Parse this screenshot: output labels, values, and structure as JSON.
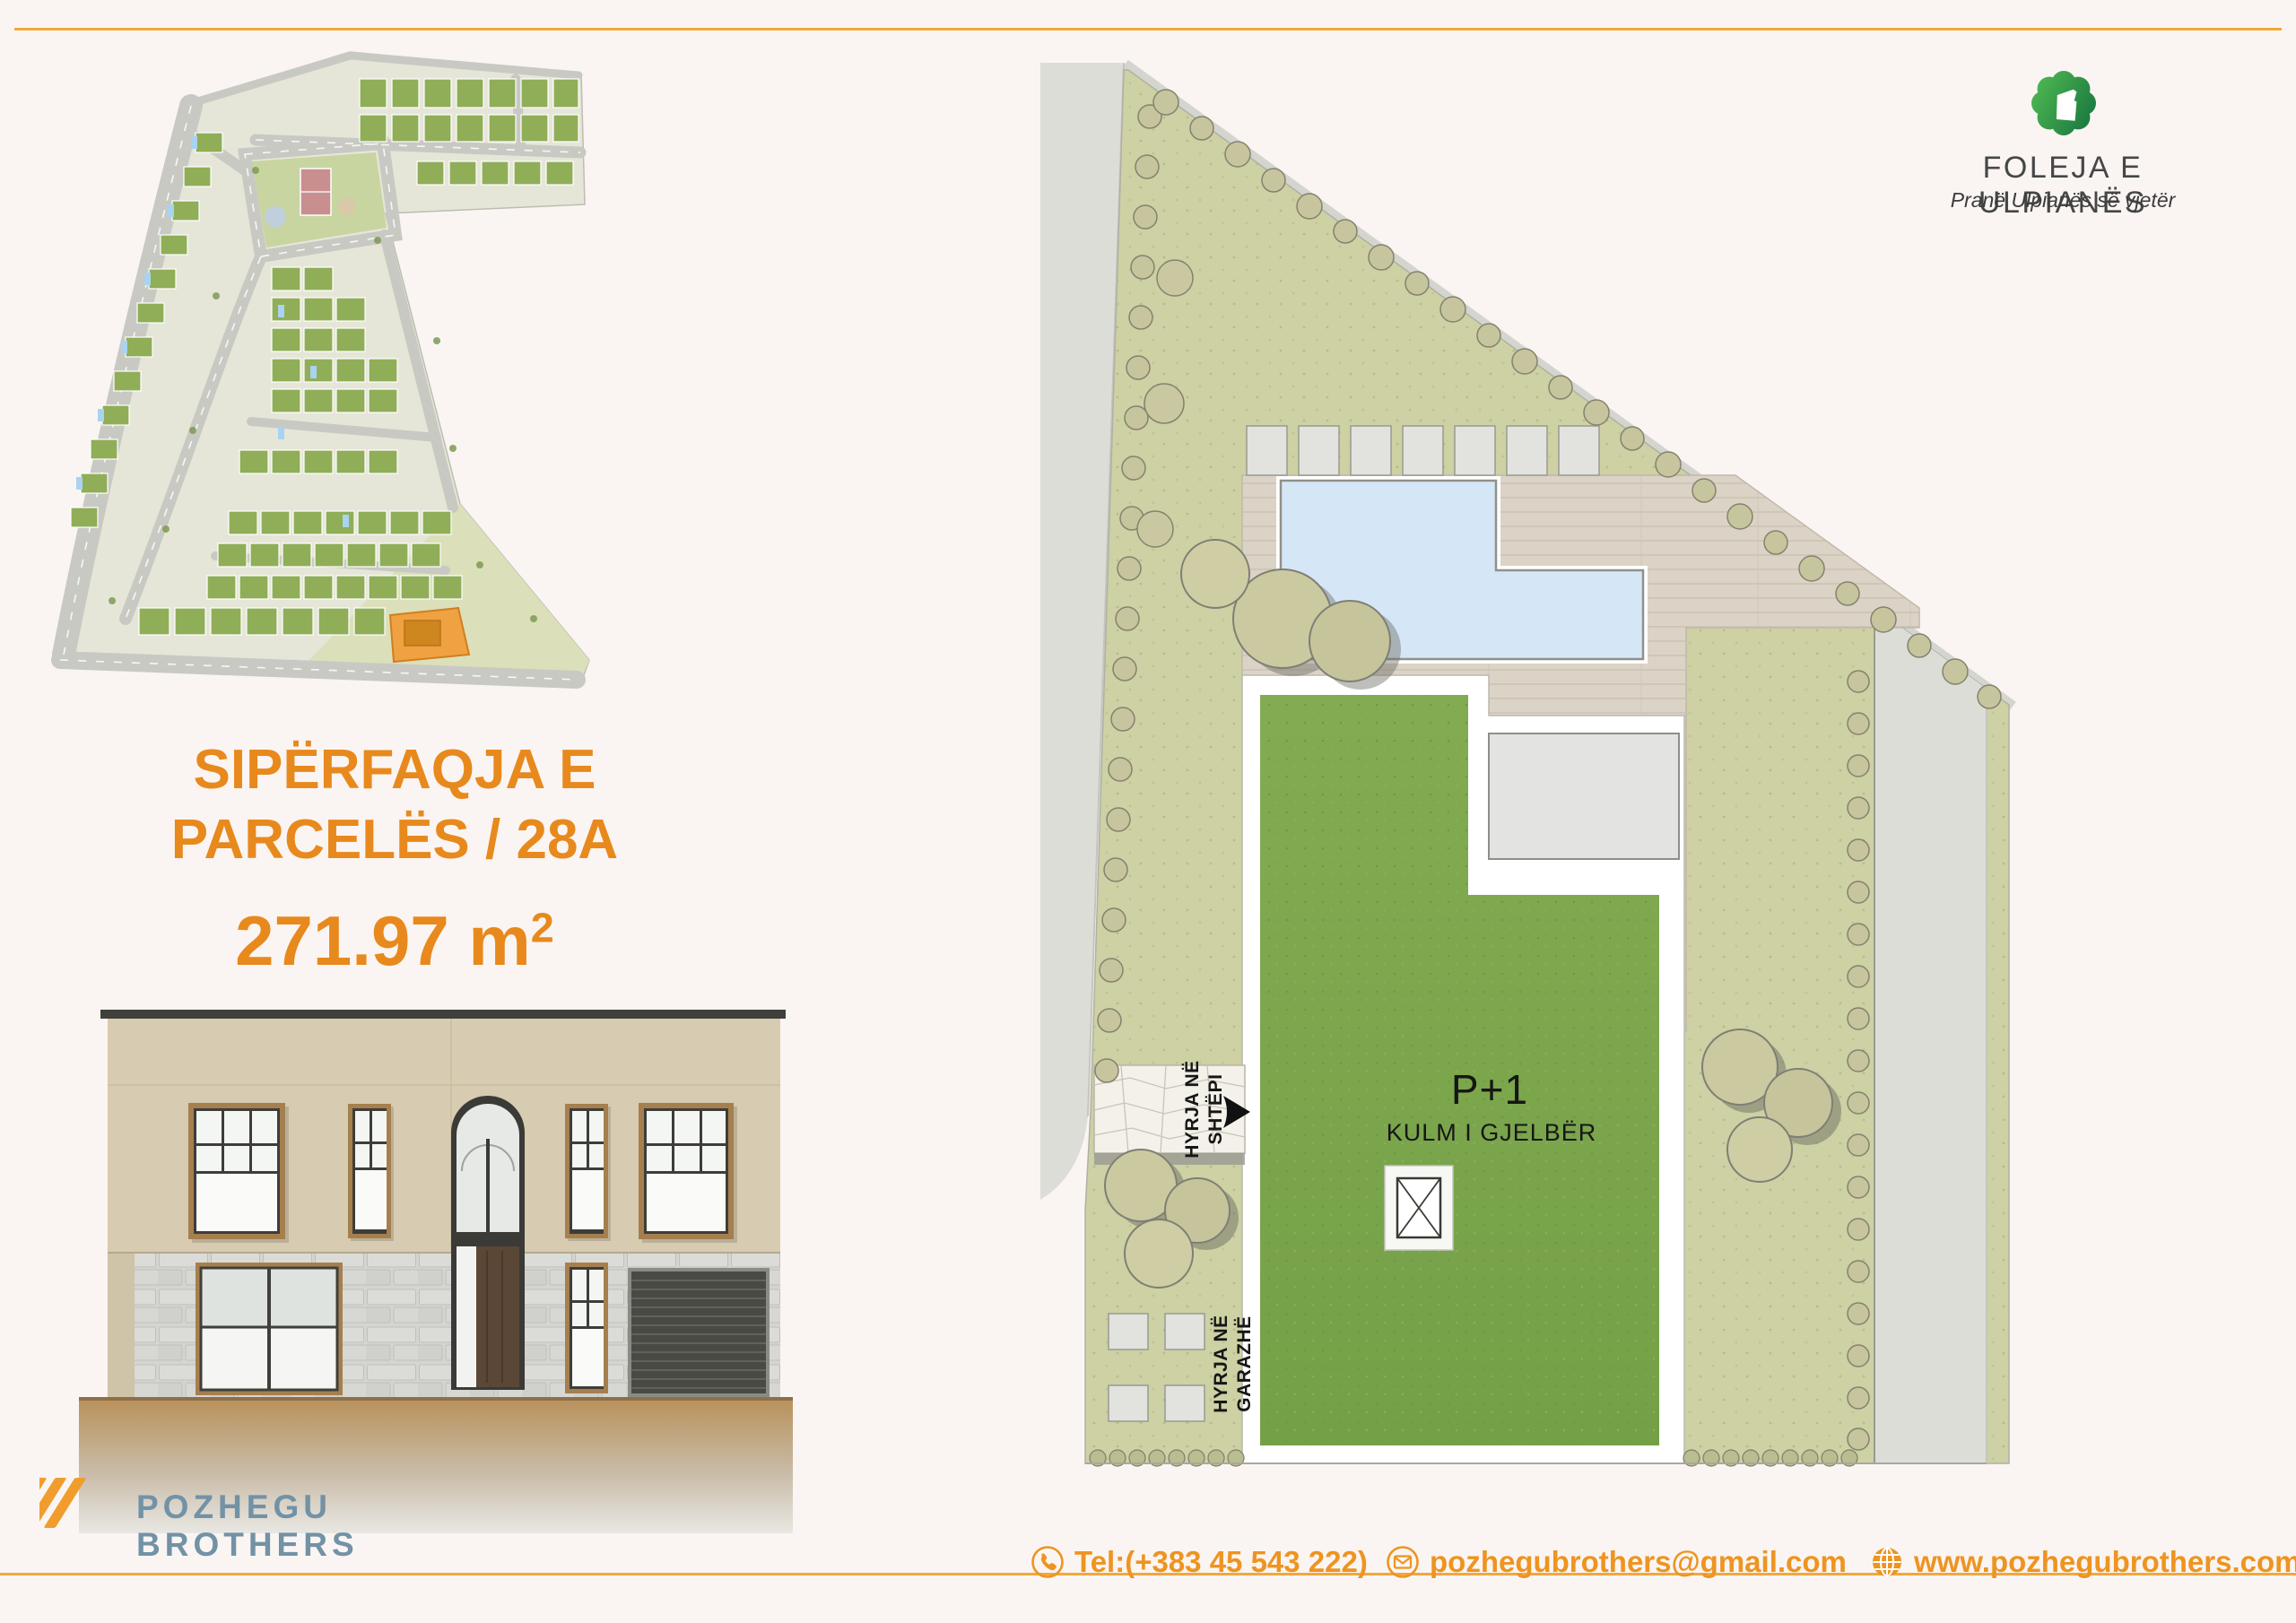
{
  "colors": {
    "background": "#FAF5F2",
    "accent_orange": "#EE9421",
    "divider_orange": "#F2A73B",
    "title_orange": "#E8891D",
    "brand_blue": "#7292A6",
    "logo_green_light": "#4AB350",
    "logo_green_dark": "#1E7E41",
    "roof_green": "#7CA64D",
    "pool_blue": "#D5E7F7",
    "highlight_parcel_orange": "#F0A141"
  },
  "brand": {
    "name": "FOLEJA E ULPIANËS",
    "tagline": "Pranë Ulpianës së vjetër"
  },
  "parcel": {
    "title_line1": "SIPËRFAQJA E",
    "title_line2": "PARCELËS / 28A",
    "area_number": "271.97 m",
    "area_exponent": "2"
  },
  "plan": {
    "floors_label": "P+1",
    "roof_label": "KULM I GJELBËR",
    "house_entry_line1": "HYRJA NË",
    "house_entry_line2": "SHTËPI",
    "garage_entry_line1": "HYRJA NË",
    "garage_entry_line2": "GARAZHË"
  },
  "footer": {
    "brand_line1": "POZHEGU",
    "brand_line2": "BROTHERS",
    "phone": "Tel:(+383 45 543 222)",
    "email": "pozhegubrothers@gmail.com",
    "website": "www.pozhegubrothers.com"
  }
}
